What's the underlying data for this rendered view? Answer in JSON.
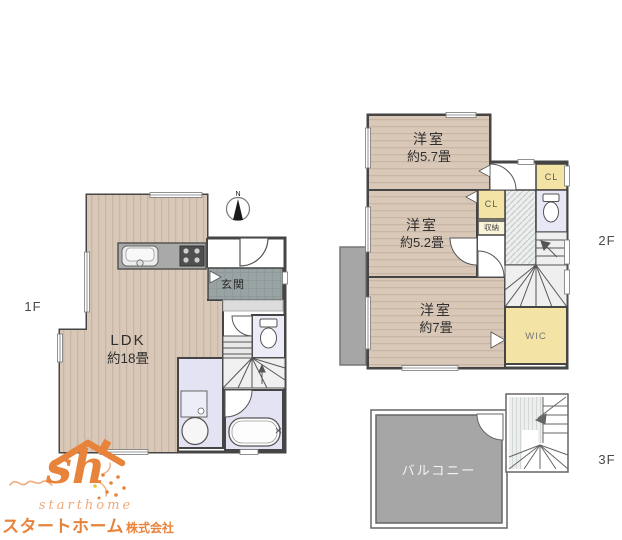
{
  "floor1": {
    "label": "1F",
    "ldk_name": "LDK",
    "ldk_size": "約18畳",
    "genkan": "玄関"
  },
  "floor2": {
    "label": "2F",
    "room1_name": "洋室",
    "room1_size": "約5.7畳",
    "room2_name": "洋室",
    "room2_size": "約5.2畳",
    "room3_name": "洋室",
    "room3_size": "約7畳",
    "cl1": "CL",
    "cl2": "CL",
    "storage": "収納",
    "wic": "WIC"
  },
  "floor3": {
    "label": "3F",
    "balcony": "バルコニー"
  },
  "compass": {
    "north": "N"
  },
  "logo": {
    "monogram": "sh",
    "name_en": "starthome",
    "name_ja": "スタートホーム",
    "company_suffix": "株式会社",
    "orange": "#E8833C",
    "orange_light": "#F2AC7C"
  },
  "palette": {
    "wood_floor": "#D9C8B8",
    "wall": "#454545",
    "entrance_tile": "#9AA3A3",
    "wet_room_floor": "#E3E3F3",
    "closet_yellow": "#F3E4A5",
    "balcony_gray": "#A6A6A6"
  }
}
